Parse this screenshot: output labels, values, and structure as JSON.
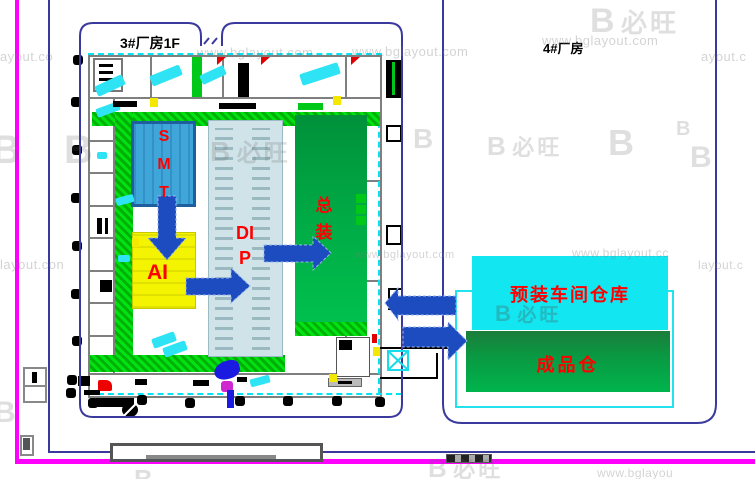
{
  "diagram": {
    "building3_title": "3#厂房1F",
    "building4_title": "4#厂房",
    "areas": {
      "smt": {
        "label": "S\nM\nT"
      },
      "ai": {
        "label": "AI"
      },
      "dip": {
        "label": "DI\nP"
      },
      "final_assembly": {
        "label": "总\n装"
      },
      "preassembly_warehouse": {
        "label": "预装车间仓库"
      },
      "finished_goods_warehouse": {
        "label": "成品仓"
      }
    },
    "flow": [
      "SMT → AI",
      "AI → DIP",
      "DIP → 总装",
      "总装 ↔ 预装车间仓库/成品仓"
    ],
    "colors": {
      "smt_fill": "#3fa6da",
      "smt_border": "#1e5fa0",
      "ai_fill": "#f4f400",
      "dip_fill": "#cfe3e8",
      "assembly_green_top": "#00913a",
      "assembly_green_bottom": "#00c04e",
      "warehouse_cyan": "#12e6f0",
      "finished_green_top": "#1b7d3a",
      "finished_green_bottom": "#00b44c",
      "arrow_blue": "#1c4cc0",
      "label_red": "#ff0000",
      "outline_navy": "#3a3a9e",
      "border_magenta": "#ff00ff",
      "hatch_green": "#00d800"
    }
  },
  "watermarks": {
    "logo_glyph": "B",
    "logo_text": "必旺",
    "items": [
      {
        "text": "ayout.co"
      },
      {
        "text": "www.bglayout.com"
      },
      {
        "text": "www.bglayout.com"
      },
      {
        "text": "www.bglayout.com"
      },
      {
        "text": "ayout.c"
      },
      {
        "text": "layout.con"
      },
      {
        "text": "www.bglayout.com"
      },
      {
        "text": "www.bglayout.cc"
      },
      {
        "text": "layout.c"
      },
      {
        "text": "www.bglayou"
      }
    ]
  }
}
